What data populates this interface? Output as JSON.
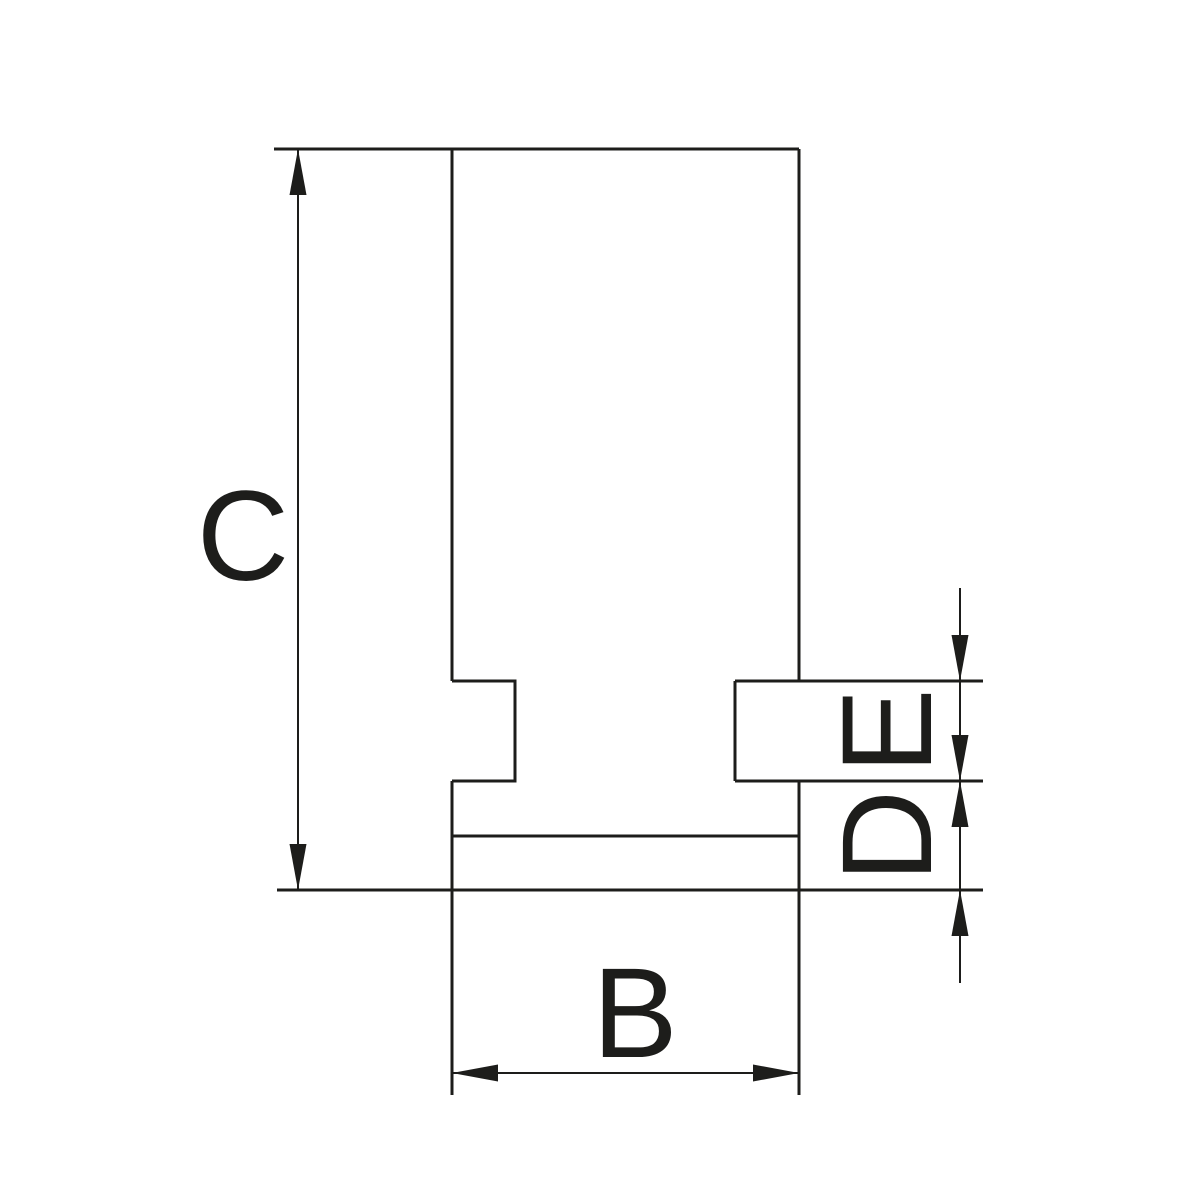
{
  "colors": {
    "background": "#ffffff",
    "line": "#1d1d1b"
  },
  "labels": {
    "c": "C",
    "b": "B",
    "d": "D",
    "e": "E"
  }
}
